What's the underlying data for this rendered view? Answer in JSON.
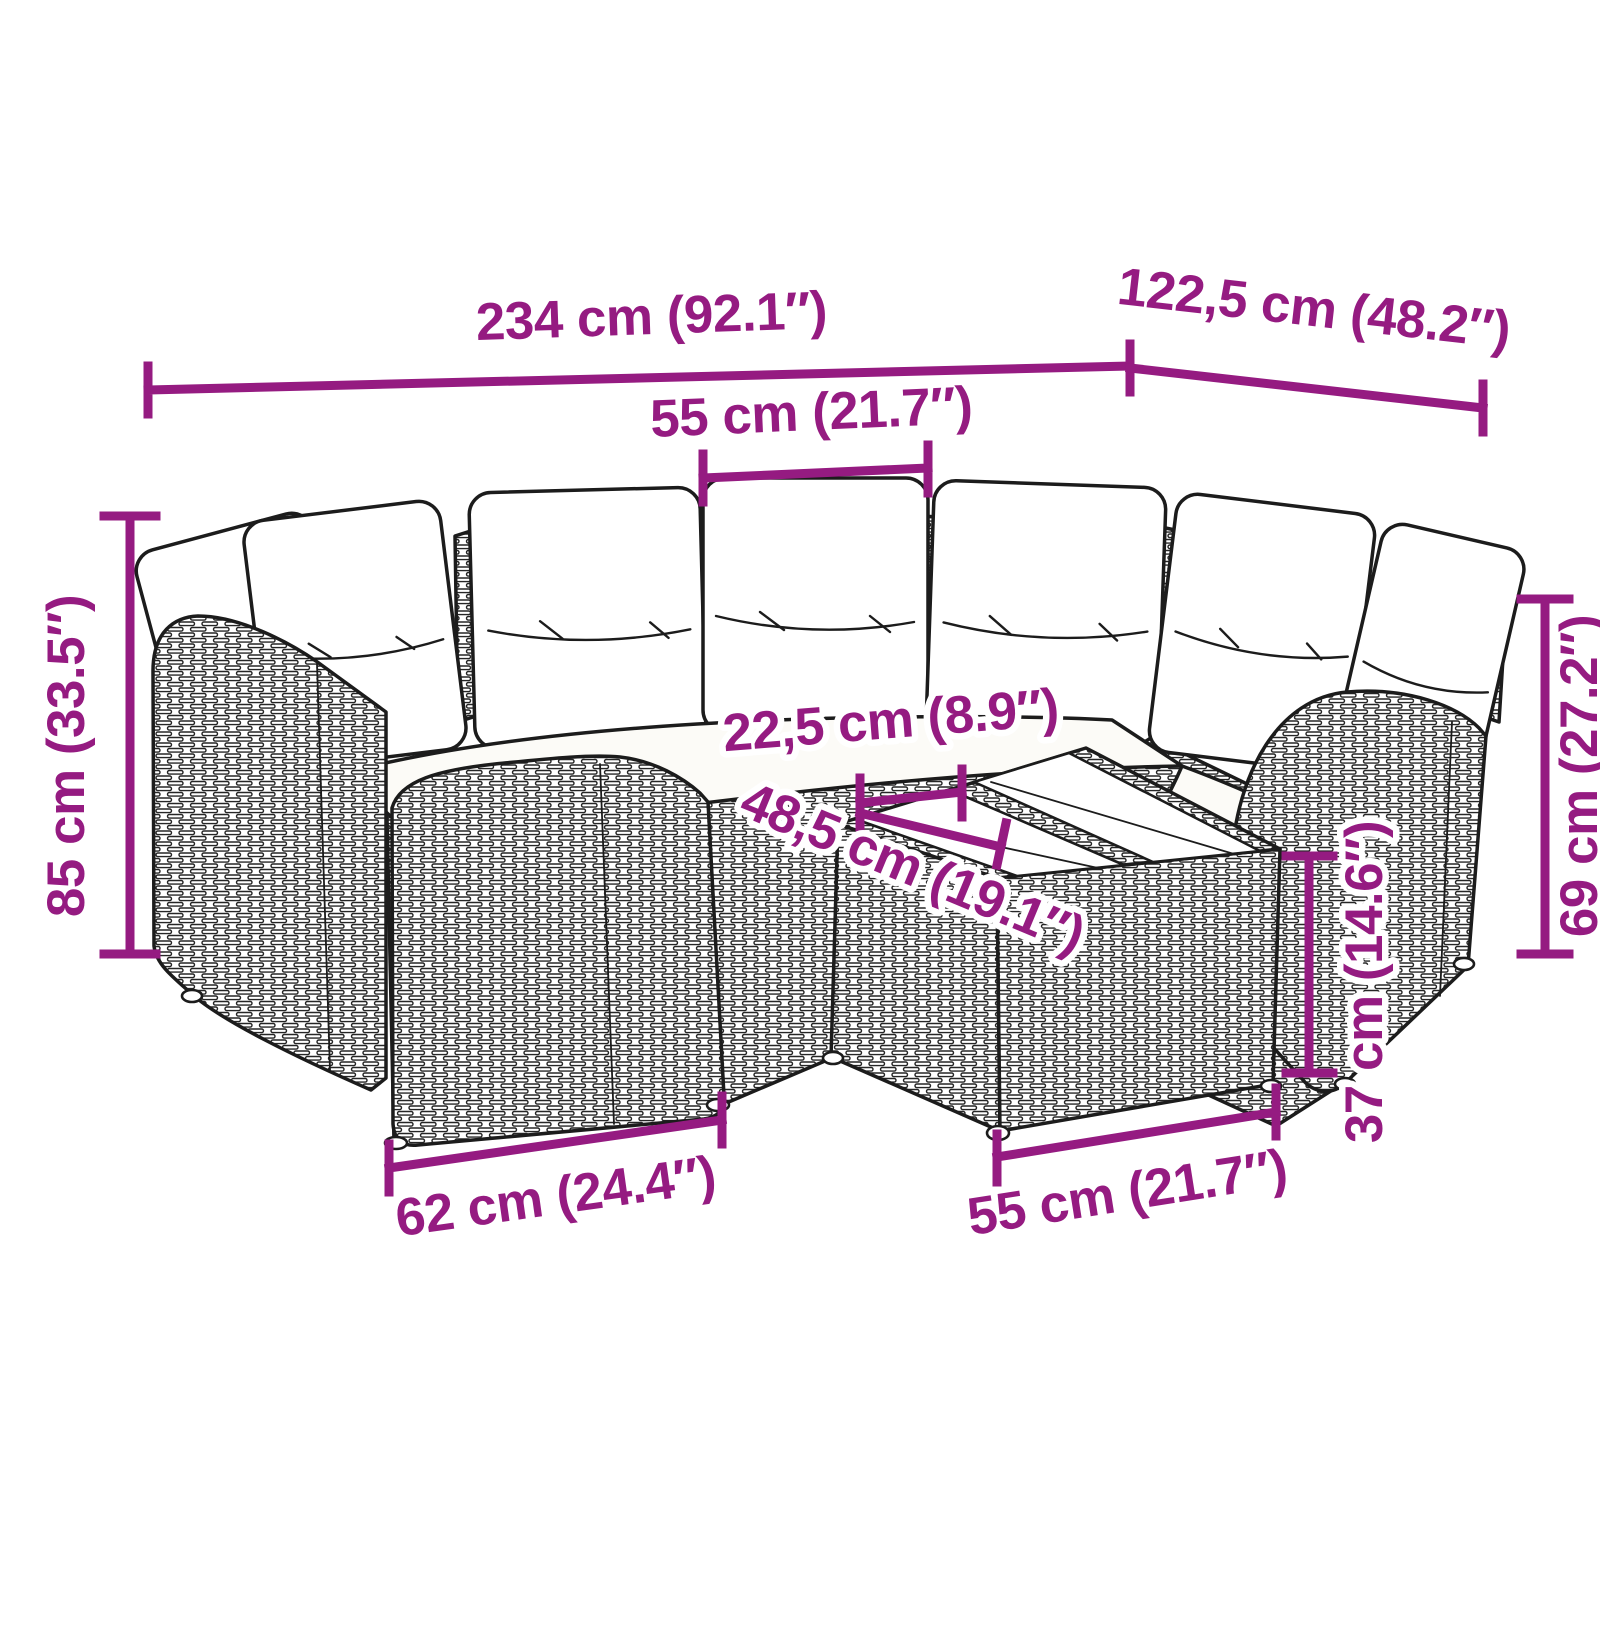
{
  "figure": {
    "subject": "L-shaped poly-rattan garden sofa set with white back and seat cushions and a glass-top coffee table, drawn as black line art with purple dimension annotations",
    "pieces": {
      "back_cushions": 7,
      "coffee_table_glass_panels": 2
    }
  },
  "style": {
    "accent_color": "#951b81",
    "line_color": "#1c1c1c",
    "cushion_color": "#ffffff",
    "background": "#ffffff"
  },
  "dims": {
    "total_width": {
      "label": "234 cm (92.1″)",
      "cm": "234",
      "inches": "92.1"
    },
    "side_depth": {
      "label": "122,5 cm (48.2″)",
      "cm": "122,5",
      "inches": "48.2"
    },
    "seat_width": {
      "label": "55 cm (21.7″)",
      "cm": "55",
      "inches": "21.7"
    },
    "total_height": {
      "label": "85 cm (33.5″)",
      "cm": "85",
      "inches": "33.5"
    },
    "gap_depth": {
      "label": "22,5 cm (8.9″)",
      "cm": "22,5",
      "inches": "8.9"
    },
    "table_depth": {
      "label": "48,5 cm (19.1″)",
      "cm": "48,5",
      "inches": "19.1"
    },
    "back_height": {
      "label": "69 cm (27.2″)",
      "cm": "69",
      "inches": "27.2"
    },
    "table_height": {
      "label": "37 cm (14.6″)",
      "cm": "37",
      "inches": "14.6"
    },
    "armrest_width": {
      "label": "62 cm (24.4″)",
      "cm": "62",
      "inches": "24.4"
    },
    "table_width": {
      "label": "55 cm (21.7″)",
      "cm": "55",
      "inches": "21.7"
    }
  }
}
